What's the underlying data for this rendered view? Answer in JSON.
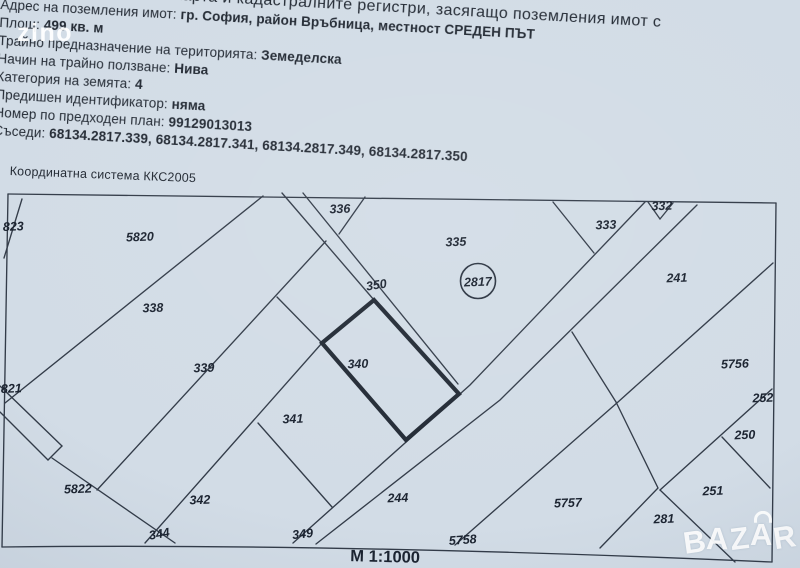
{
  "colors": {
    "paper": "#d2dce6",
    "ink": "#323b48",
    "label": "#1b2330",
    "watermark": "#ffffff"
  },
  "watermarks": {
    "top_left": "zino",
    "bazar": {
      "l1": "B",
      "l2": "A",
      "l3": "Z",
      "bag": "A",
      "l5": "R"
    }
  },
  "header": {
    "lines": [
      {
        "pre": "та карта и кадастралните регистри, засягащо поземления имот с ",
        "bold": ""
      },
      {
        "pre": "Адрес на поземления имот: ",
        "bold": "гр. София, район Връбница, местност СРЕДЕН ПЪТ"
      },
      {
        "pre": "Площ: ",
        "bold": "499 кв. м"
      },
      {
        "pre": "Трайно предназначение на територията: ",
        "bold": "Земеделска"
      },
      {
        "pre": "Начин на трайно ползване: ",
        "bold": "Нива"
      },
      {
        "pre": "Категория на земята: ",
        "bold": "4"
      },
      {
        "pre": "Предишен идентификатор: ",
        "bold": "няма"
      },
      {
        "pre": "Номер по предходен план: ",
        "bold": "99129013013"
      },
      {
        "pre": "Съседи: ",
        "bold": "68134.2817.339, 68134.2817.341, 68134.2817.349, 68134.2817.350"
      }
    ]
  },
  "map": {
    "coordinate_system": "Координатна система ККС2005",
    "scale": "М 1:1000",
    "highlight_parcel": "2817",
    "parcels": [
      {
        "n": "823",
        "x": 3,
        "y": 231,
        "anchor": "start"
      },
      {
        "n": "5820",
        "x": 140,
        "y": 241
      },
      {
        "n": "336",
        "x": 340,
        "y": 213
      },
      {
        "n": "333",
        "x": 606,
        "y": 229
      },
      {
        "n": "332",
        "x": 662,
        "y": 210
      },
      {
        "n": "335",
        "x": 456,
        "y": 246
      },
      {
        "n": "241",
        "x": 677,
        "y": 282
      },
      {
        "n": "350",
        "x": 377,
        "y": 289,
        "r": -9
      },
      {
        "n": "338",
        "x": 153,
        "y": 312
      },
      {
        "n": "340",
        "x": 358,
        "y": 368
      },
      {
        "n": "339",
        "x": 204,
        "y": 372
      },
      {
        "n": "5756",
        "x": 735,
        "y": 368
      },
      {
        "n": "341",
        "x": 293,
        "y": 423
      },
      {
        "n": "821",
        "x": 1,
        "y": 393,
        "anchor": "start"
      },
      {
        "n": "252",
        "x": 763,
        "y": 402
      },
      {
        "n": "250",
        "x": 745,
        "y": 439
      },
      {
        "n": "5822",
        "x": 78,
        "y": 493
      },
      {
        "n": "342",
        "x": 200,
        "y": 504
      },
      {
        "n": "244",
        "x": 398,
        "y": 502
      },
      {
        "n": "5757",
        "x": 568,
        "y": 507
      },
      {
        "n": "251",
        "x": 713,
        "y": 495
      },
      {
        "n": "281",
        "x": 664,
        "y": 523
      },
      {
        "n": "344",
        "x": 160,
        "y": 538,
        "r": -10
      },
      {
        "n": "349",
        "x": 303,
        "y": 538,
        "r": -6
      },
      {
        "n": "5758",
        "x": 463,
        "y": 544,
        "r": -4
      },
      {
        "n": "2817",
        "x": 478,
        "y": 286
      }
    ]
  }
}
